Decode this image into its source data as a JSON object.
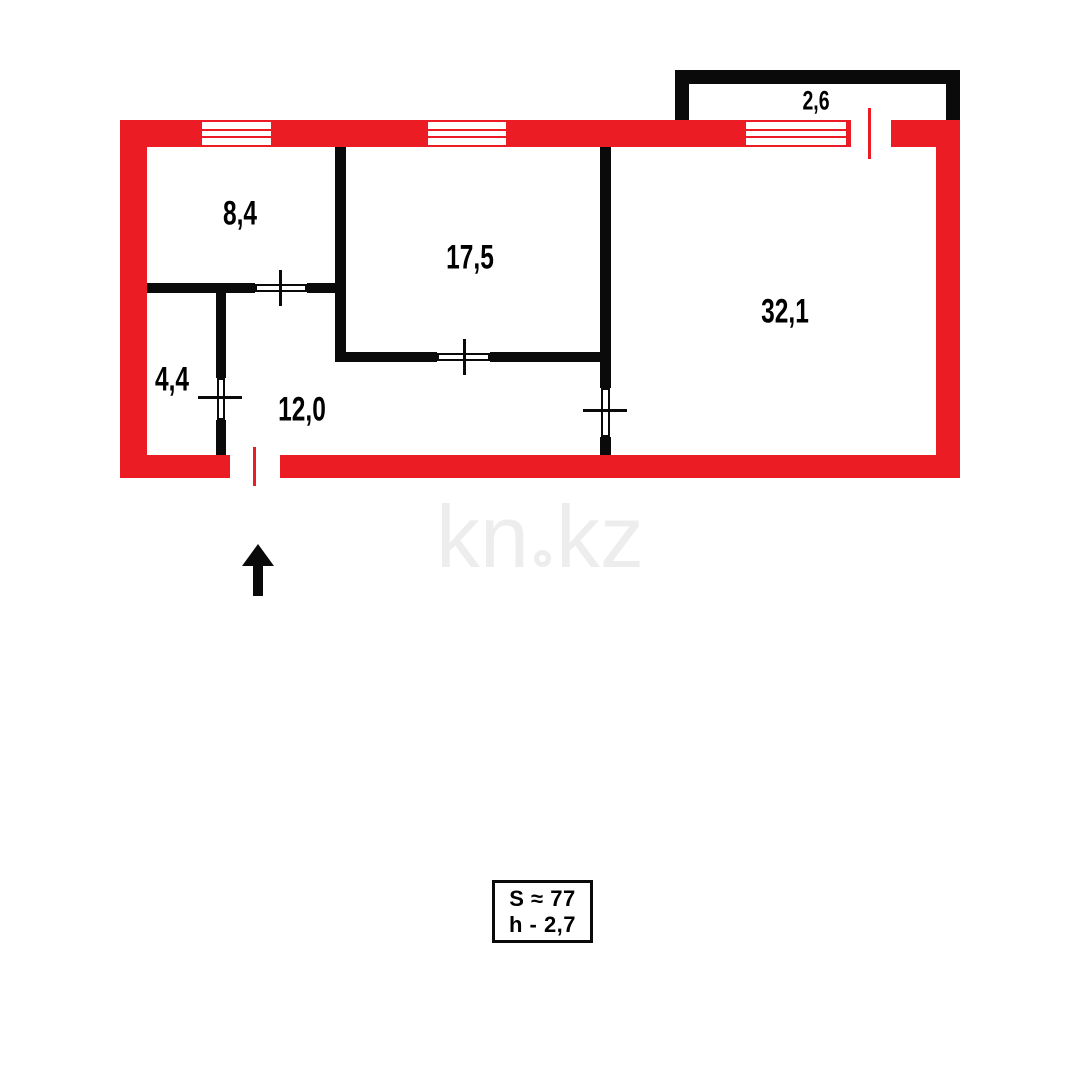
{
  "colors": {
    "exterior_wall_red": "#ec1c24",
    "interior_wall_black": "#0a0a0a",
    "label_text": "#000000",
    "watermark_gray": "#ededed"
  },
  "plan": {
    "rooms": [
      {
        "label": "8,4"
      },
      {
        "label": "17,5"
      },
      {
        "label": "32,1"
      },
      {
        "label": "4,4"
      },
      {
        "label": "12,0"
      }
    ],
    "balcony": {
      "label": "2,6"
    },
    "info_box": {
      "area_line": "S ≈ 77",
      "height_line": "h - 2,7"
    },
    "watermark": {
      "text": "kn.kz",
      "part1": "kn",
      "part2": "kz"
    },
    "icons": {
      "north_arrow": "up-arrow"
    }
  }
}
